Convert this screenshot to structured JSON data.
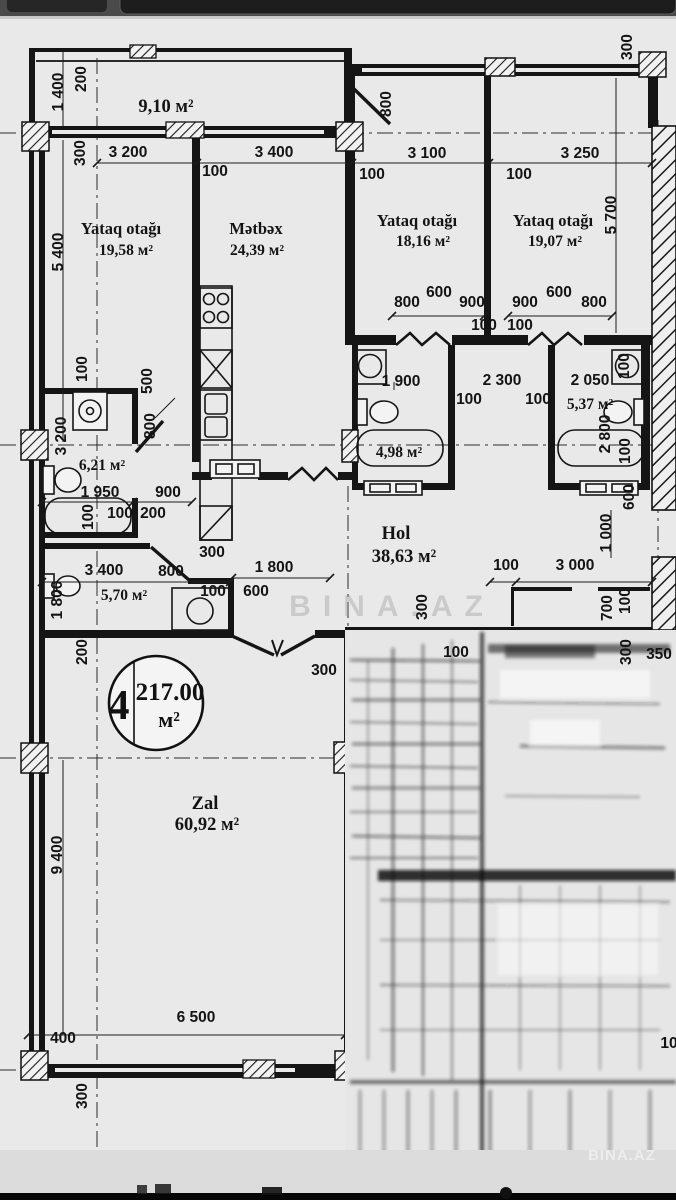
{
  "watermarks": {
    "center": "BINA.AZ",
    "corner": "BINA.AZ"
  },
  "unit_badge": {
    "number": "4",
    "area": "217.00",
    "unit": "м²"
  },
  "rooms": {
    "balcony": {
      "area": "9,10 м²"
    },
    "bedroom1": {
      "name": "Yataq otağı",
      "area": "19,58 м²"
    },
    "kitchen": {
      "name": "Mətbəx",
      "area": "24,39 м²"
    },
    "bedroom2": {
      "name": "Yataq otağı",
      "area": "18,16 м²"
    },
    "bedroom3": {
      "name": "Yataq otağı",
      "area": "19,07 м²"
    },
    "bath1": {
      "area": "6,21 м²"
    },
    "bath2": {
      "area": "4,98 м²"
    },
    "bath3": {
      "area": "5,37 м²"
    },
    "wc": {
      "area": "5,70 м²"
    },
    "hall": {
      "name": "Hol",
      "area": "38,63 м²"
    },
    "living": {
      "name": "Zal",
      "area": "60,92 м²"
    }
  },
  "dimensions": [
    {
      "t": "1 400",
      "x": 63,
      "y": 92,
      "r": -90
    },
    {
      "t": "200",
      "x": 86,
      "y": 79,
      "r": -90
    },
    {
      "t": "300",
      "x": 85,
      "y": 153,
      "r": -90
    },
    {
      "t": "3 200",
      "x": 128,
      "y": 157
    },
    {
      "t": "3 400",
      "x": 274,
      "y": 157
    },
    {
      "t": "100",
      "x": 215,
      "y": 176
    },
    {
      "t": "800",
      "x": 391,
      "y": 104,
      "r": -90
    },
    {
      "t": "3 100",
      "x": 427,
      "y": 158
    },
    {
      "t": "3 250",
      "x": 580,
      "y": 158
    },
    {
      "t": "100",
      "x": 372,
      "y": 179
    },
    {
      "t": "100",
      "x": 519,
      "y": 179
    },
    {
      "t": "300",
      "x": 632,
      "y": 47,
      "r": -90
    },
    {
      "t": "5 700",
      "x": 616,
      "y": 215,
      "r": -90
    },
    {
      "t": "5 400",
      "x": 63,
      "y": 252,
      "r": -90
    },
    {
      "t": "800",
      "x": 407,
      "y": 307
    },
    {
      "t": "600",
      "x": 439,
      "y": 297
    },
    {
      "t": "900",
      "x": 472,
      "y": 307
    },
    {
      "t": "900",
      "x": 525,
      "y": 307
    },
    {
      "t": "600",
      "x": 559,
      "y": 297
    },
    {
      "t": "800",
      "x": 594,
      "y": 307
    },
    {
      "t": "100",
      "x": 484,
      "y": 330
    },
    {
      "t": "100",
      "x": 520,
      "y": 330
    },
    {
      "t": "1 900",
      "x": 401,
      "y": 386
    },
    {
      "t": "2 300",
      "x": 502,
      "y": 385
    },
    {
      "t": "2 050",
      "x": 590,
      "y": 385
    },
    {
      "t": "100",
      "x": 469,
      "y": 404
    },
    {
      "t": "100",
      "x": 538,
      "y": 404
    },
    {
      "t": "2 800",
      "x": 610,
      "y": 434,
      "r": -90
    },
    {
      "t": "100",
      "x": 629,
      "y": 366,
      "r": -90
    },
    {
      "t": "100",
      "x": 630,
      "y": 451,
      "r": -90
    },
    {
      "t": "100",
      "x": 87,
      "y": 369,
      "r": -90
    },
    {
      "t": "500",
      "x": 152,
      "y": 381,
      "r": -90
    },
    {
      "t": "800",
      "x": 155,
      "y": 426,
      "r": -90
    },
    {
      "t": "3 200",
      "x": 66,
      "y": 436,
      "r": -90
    },
    {
      "t": "1 950",
      "x": 100,
      "y": 497
    },
    {
      "t": "900",
      "x": 168,
      "y": 497
    },
    {
      "t": "100",
      "x": 93,
      "y": 517,
      "r": -90
    },
    {
      "t": "100",
      "x": 120,
      "y": 518
    },
    {
      "t": "200",
      "x": 153,
      "y": 518
    },
    {
      "t": "3 400",
      "x": 104,
      "y": 575
    },
    {
      "t": "300",
      "x": 212,
      "y": 557
    },
    {
      "t": "800",
      "x": 171,
      "y": 576
    },
    {
      "t": "100",
      "x": 213,
      "y": 596
    },
    {
      "t": "600",
      "x": 256,
      "y": 596
    },
    {
      "t": "1 800",
      "x": 62,
      "y": 600,
      "r": -90,
      "s": 18
    },
    {
      "t": "1 800",
      "x": 274,
      "y": 572
    },
    {
      "t": "100",
      "x": 506,
      "y": 570
    },
    {
      "t": "3 000",
      "x": 575,
      "y": 570
    },
    {
      "t": "600",
      "x": 634,
      "y": 497,
      "r": -90
    },
    {
      "t": "1 000",
      "x": 611,
      "y": 533,
      "r": -90
    },
    {
      "t": "700",
      "x": 612,
      "y": 608,
      "r": -90
    },
    {
      "t": "100",
      "x": 630,
      "y": 601,
      "r": -90
    },
    {
      "t": "300",
      "x": 427,
      "y": 607,
      "r": -90
    },
    {
      "t": "300",
      "x": 631,
      "y": 652,
      "r": -90
    },
    {
      "t": "350",
      "x": 659,
      "y": 659
    },
    {
      "t": "300",
      "x": 324,
      "y": 675
    },
    {
      "t": "200",
      "x": 87,
      "y": 652,
      "r": -90,
      "s": 19
    },
    {
      "t": "9 400",
      "x": 62,
      "y": 855,
      "r": -90,
      "s": 21
    },
    {
      "t": "6 500",
      "x": 196,
      "y": 1022,
      "s": 21
    },
    {
      "t": "400",
      "x": 63,
      "y": 1043,
      "s": 20
    },
    {
      "t": "300",
      "x": 87,
      "y": 1096,
      "r": -90,
      "s": 20
    },
    {
      "t": "100",
      "x": 456,
      "y": 657,
      "s": 17
    },
    {
      "t": "10",
      "x": 669,
      "y": 1048,
      "s": 17
    }
  ]
}
